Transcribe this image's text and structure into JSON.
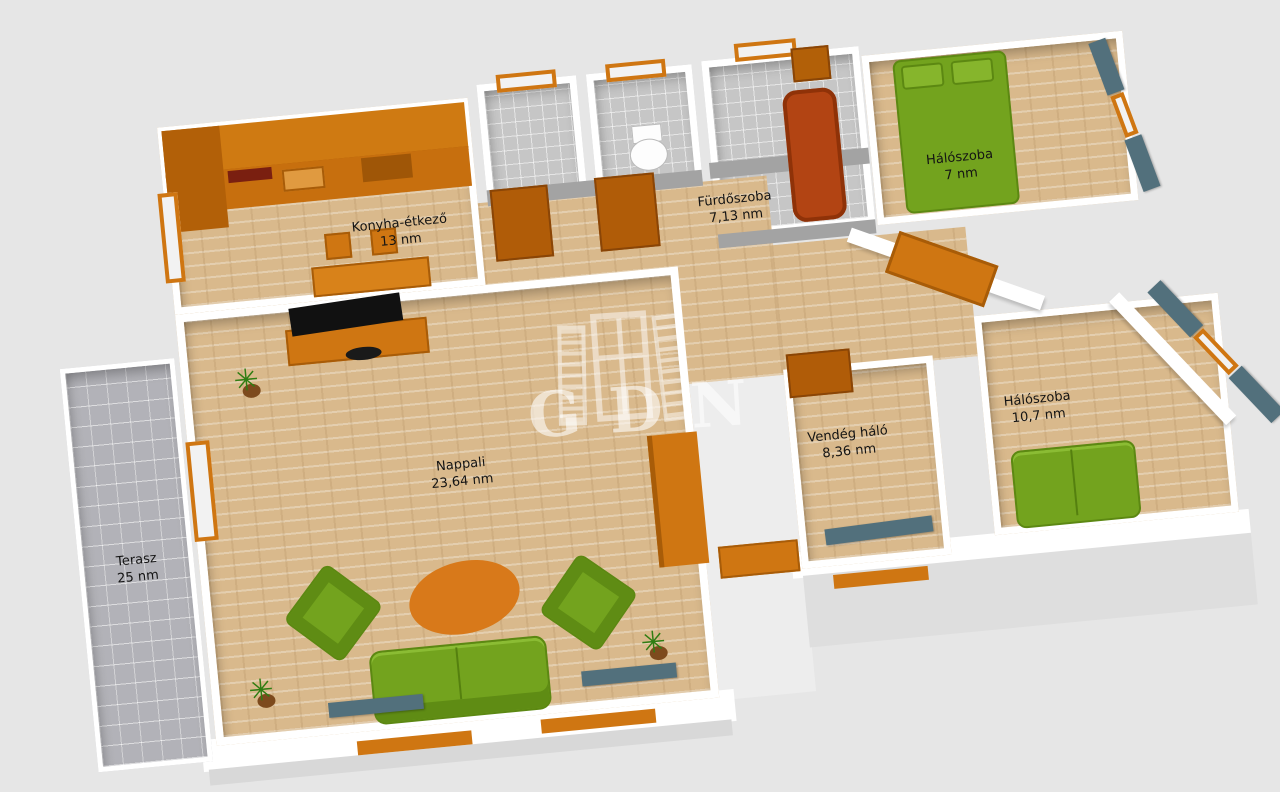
{
  "title": "3D floor plan",
  "watermark": {
    "text": "GDN",
    "icon": "window-with-shutters-icon"
  },
  "rooms": [
    {
      "id": "terasz",
      "name": "Terasz",
      "area": "25 nm"
    },
    {
      "id": "konyha-etkezo",
      "name": "Konyha-étkező",
      "area": "13 nm"
    },
    {
      "id": "furdoszoba",
      "name": "Fürdőszoba",
      "area": "7,13 nm"
    },
    {
      "id": "haloszoba-felso",
      "name": "Hálószoba",
      "area": "7 nm"
    },
    {
      "id": "nappali",
      "name": "Nappali",
      "area": "23,64 nm"
    },
    {
      "id": "vendeg-halo",
      "name": "Vendég háló",
      "area": "8,36 nm"
    },
    {
      "id": "haloszoba-jobb",
      "name": "Hálószoba",
      "area": "10,7 nm"
    }
  ],
  "colors": {
    "background": "#e6e6e6",
    "wall": "#ffffff",
    "floor_wood": "#d9b98c",
    "floor_tile": "#c6c6c6",
    "cabinet_orange": "#cf7612",
    "cabinet_dark_orange": "#a85c08",
    "sofa_green": "#73a31e",
    "curtain_slate": "#52707c",
    "bathtub_rust": "#b24413",
    "label_text": "#141414"
  }
}
